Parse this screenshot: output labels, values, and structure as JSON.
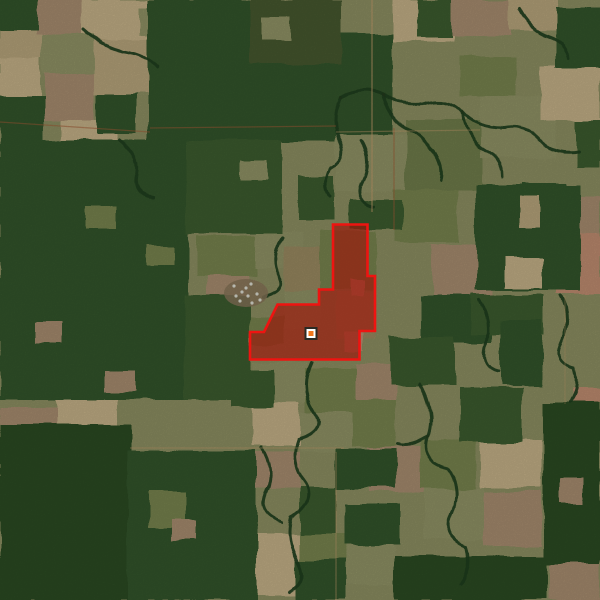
{
  "palette": {
    "base": "#8a8c60",
    "forest_colors": [
      "#2c4824",
      "#335229",
      "#3a5a2e",
      "#273f20",
      "#44572e"
    ],
    "field_colors": [
      "#b3a179",
      "#c0ad85",
      "#8d9063",
      "#a48a6d",
      "#97875f",
      "#bb8a6e",
      "#75814e",
      "#6d7a49"
    ],
    "stream": "#1f3c1d",
    "road": "#c09a6b",
    "road_red": "#9e5a35",
    "smoke_bg": "#857257",
    "smoke_dot": "#dcded4"
  },
  "scene": {
    "fields": [
      [
        0,
        28,
        42,
        30,
        0
      ],
      [
        36,
        0,
        46,
        34,
        3
      ],
      [
        82,
        0,
        68,
        40,
        1
      ],
      [
        42,
        34,
        52,
        40,
        2
      ],
      [
        0,
        58,
        40,
        44,
        1
      ],
      [
        94,
        40,
        56,
        54,
        0
      ],
      [
        44,
        74,
        50,
        46,
        3
      ],
      [
        140,
        8,
        52,
        28,
        2
      ],
      [
        60,
        120,
        58,
        26,
        1
      ],
      [
        150,
        0,
        62,
        22,
        2
      ],
      [
        214,
        0,
        50,
        16,
        1
      ],
      [
        392,
        0,
        62,
        42,
        1
      ],
      [
        452,
        0,
        58,
        36,
        3
      ],
      [
        508,
        0,
        50,
        30,
        0
      ],
      [
        336,
        134,
        70,
        58,
        2
      ],
      [
        406,
        120,
        76,
        70,
        7
      ],
      [
        480,
        96,
        76,
        62,
        2
      ],
      [
        540,
        66,
        60,
        54,
        1
      ],
      [
        394,
        190,
        64,
        52,
        6
      ],
      [
        432,
        244,
        62,
        52,
        3
      ],
      [
        576,
        196,
        24,
        42,
        3
      ],
      [
        556,
        232,
        44,
        62,
        5
      ],
      [
        336,
        64,
        54,
        54,
        0
      ],
      [
        460,
        56,
        56,
        40,
        6
      ],
      [
        196,
        236,
        60,
        40,
        6
      ],
      [
        254,
        232,
        48,
        36,
        2
      ],
      [
        284,
        246,
        44,
        44,
        4
      ],
      [
        250,
        316,
        34,
        28,
        6
      ],
      [
        208,
        276,
        40,
        36,
        3
      ],
      [
        284,
        290,
        36,
        40,
        2
      ],
      [
        320,
        230,
        56,
        60,
        6
      ],
      [
        336,
        292,
        40,
        48,
        4
      ],
      [
        345,
        333,
        18,
        20,
        5
      ],
      [
        350,
        280,
        14,
        16,
        5
      ],
      [
        252,
        362,
        56,
        40,
        2
      ],
      [
        306,
        368,
        52,
        44,
        6
      ],
      [
        356,
        364,
        40,
        36,
        3
      ],
      [
        252,
        402,
        48,
        44,
        1
      ],
      [
        300,
        412,
        56,
        40,
        2
      ],
      [
        352,
        400,
        44,
        46,
        6
      ],
      [
        0,
        408,
        56,
        34,
        3
      ],
      [
        56,
        396,
        62,
        38,
        1
      ],
      [
        0,
        444,
        44,
        40,
        2
      ],
      [
        0,
        484,
        50,
        46,
        1
      ],
      [
        0,
        530,
        54,
        42,
        3
      ],
      [
        0,
        572,
        58,
        28,
        2
      ],
      [
        60,
        448,
        60,
        50,
        0
      ],
      [
        64,
        498,
        58,
        54,
        2
      ],
      [
        88,
        552,
        44,
        48,
        3
      ],
      [
        136,
        540,
        56,
        56,
        1
      ],
      [
        190,
        560,
        44,
        40,
        2
      ],
      [
        368,
        446,
        56,
        46,
        3
      ],
      [
        420,
        440,
        56,
        48,
        6
      ],
      [
        424,
        488,
        60,
        52,
        2
      ],
      [
        480,
        440,
        62,
        48,
        1
      ],
      [
        484,
        492,
        58,
        54,
        3
      ],
      [
        300,
        534,
        46,
        30,
        6
      ],
      [
        346,
        546,
        48,
        38,
        2
      ],
      [
        248,
        534,
        52,
        62,
        1
      ],
      [
        548,
        564,
        52,
        36,
        3
      ],
      [
        252,
        452,
        48,
        36,
        3
      ],
      [
        572,
        388,
        28,
        20,
        5
      ]
    ],
    "forest": [
      [
        148,
        0,
        188,
        142,
        1
      ],
      [
        332,
        34,
        60,
        100,
        1
      ],
      [
        250,
        0,
        92,
        64,
        4
      ],
      [
        0,
        140,
        188,
        260,
        1
      ],
      [
        0,
        425,
        132,
        175,
        0
      ],
      [
        128,
        450,
        128,
        150,
        1
      ],
      [
        186,
        140,
        96,
        94,
        2
      ],
      [
        184,
        296,
        66,
        104,
        2
      ],
      [
        298,
        176,
        36,
        44,
        2
      ],
      [
        350,
        200,
        52,
        28,
        2
      ],
      [
        420,
        296,
        72,
        46,
        1
      ],
      [
        390,
        336,
        66,
        50,
        2
      ],
      [
        476,
        184,
        104,
        106,
        1
      ],
      [
        472,
        294,
        72,
        40,
        2
      ],
      [
        500,
        320,
        42,
        66,
        1
      ],
      [
        544,
        402,
        56,
        162,
        0
      ],
      [
        556,
        8,
        44,
        60,
        1
      ],
      [
        576,
        120,
        24,
        48,
        2
      ],
      [
        522,
        182,
        46,
        32,
        1
      ],
      [
        344,
        504,
        56,
        42,
        1
      ],
      [
        394,
        556,
        152,
        44,
        0
      ],
      [
        296,
        560,
        50,
        40,
        1
      ],
      [
        460,
        388,
        62,
        54,
        2
      ],
      [
        0,
        0,
        38,
        30,
        1
      ],
      [
        96,
        94,
        40,
        40,
        1
      ],
      [
        418,
        0,
        34,
        38,
        2
      ],
      [
        336,
        448,
        60,
        40,
        1
      ],
      [
        300,
        486,
        36,
        48,
        2
      ],
      [
        0,
        96,
        44,
        44,
        1
      ],
      [
        230,
        370,
        44,
        36,
        2
      ]
    ],
    "clearings": [
      [
        506,
        258,
        36,
        30,
        1
      ],
      [
        520,
        196,
        20,
        32,
        0
      ],
      [
        150,
        492,
        36,
        36,
        6
      ],
      [
        262,
        18,
        30,
        22,
        2
      ],
      [
        86,
        206,
        30,
        22,
        6
      ],
      [
        36,
        322,
        26,
        20,
        3
      ],
      [
        146,
        246,
        28,
        20,
        6
      ],
      [
        104,
        370,
        30,
        22,
        3
      ],
      [
        172,
        520,
        24,
        20,
        3
      ],
      [
        560,
        478,
        24,
        26,
        3
      ],
      [
        240,
        160,
        26,
        20,
        2
      ]
    ],
    "streams": [
      "M340,98 Q364,86 382,96 T424,104 Q448,96 462,112 T504,128 Q526,124 540,140 T578,152",
      "M382,96 Q390,120 406,128 T430,150 Q444,162 440,180",
      "M462,112 Q466,140 484,150 T502,176",
      "M340,98 Q330,120 340,140 T330,168 Q322,184 330,198",
      "M282,238 Q270,258 278,274 T262,296",
      "M312,362 Q300,388 314,410 T298,440 Q290,462 304,480 T292,516 Q286,540 298,560 T290,592",
      "M420,384 Q436,412 428,436 T448,468 Q462,488 452,512 T466,546 Q472,566 460,584",
      "M428,436 Q410,448 398,444",
      "M560,296 Q572,318 562,340 T574,368 Q580,388 570,402",
      "M262,448 Q276,470 266,492 T282,522",
      "M84,30 Q104,48 126,52 T158,68",
      "M120,140 Q140,156 136,176 T154,198",
      "M520,10 Q530,30 548,36 T570,58",
      "M360,140 Q372,160 362,180 T374,206",
      "M480,300 Q492,320 486,344 T498,372"
    ],
    "roads": [
      [
        372,
        0,
        372,
        212,
        "t",
        0.7
      ],
      [
        394,
        128,
        394,
        230,
        "r",
        0.6
      ],
      [
        150,
        128,
        336,
        126,
        "r",
        0.55
      ],
      [
        0,
        122,
        150,
        132,
        "r",
        0.55
      ],
      [
        336,
        132,
        480,
        130,
        "t",
        0.45
      ],
      [
        336,
        452,
        336,
        600,
        "t",
        0.5
      ],
      [
        130,
        448,
        344,
        448,
        "t",
        0.45
      ],
      [
        565,
        296,
        565,
        404,
        "t",
        0.35
      ]
    ],
    "smoke": {
      "cx": 246,
      "cy": 293,
      "rx": 22,
      "ry": 14,
      "dots": [
        [
          234,
          286
        ],
        [
          242,
          292
        ],
        [
          251,
          284
        ],
        [
          257,
          294
        ],
        [
          240,
          301
        ],
        [
          252,
          303
        ],
        [
          246,
          288
        ],
        [
          236,
          296
        ],
        [
          260,
          300
        ],
        [
          248,
          296
        ]
      ]
    }
  },
  "overlay": {
    "points": [
      [
        333,
        224.5
      ],
      [
        367.5,
        224.5
      ],
      [
        367.5,
        276
      ],
      [
        375,
        276
      ],
      [
        375,
        331
      ],
      [
        359.5,
        331
      ],
      [
        359.5,
        359.5
      ],
      [
        250,
        359.5
      ],
      [
        250,
        332
      ],
      [
        264,
        332
      ],
      [
        277.5,
        304.5
      ],
      [
        319,
        304.5
      ],
      [
        319,
        289.5
      ],
      [
        333,
        289.5
      ]
    ],
    "fill": "rgba(158,22,9,0.66)",
    "stroke": "#ee1411",
    "stroke_width": 2.6
  },
  "marker": {
    "x": 311,
    "y": 333.5,
    "size": 13,
    "border": "#2b2a24",
    "ring": "#ffffff",
    "center": "#f1771d"
  }
}
